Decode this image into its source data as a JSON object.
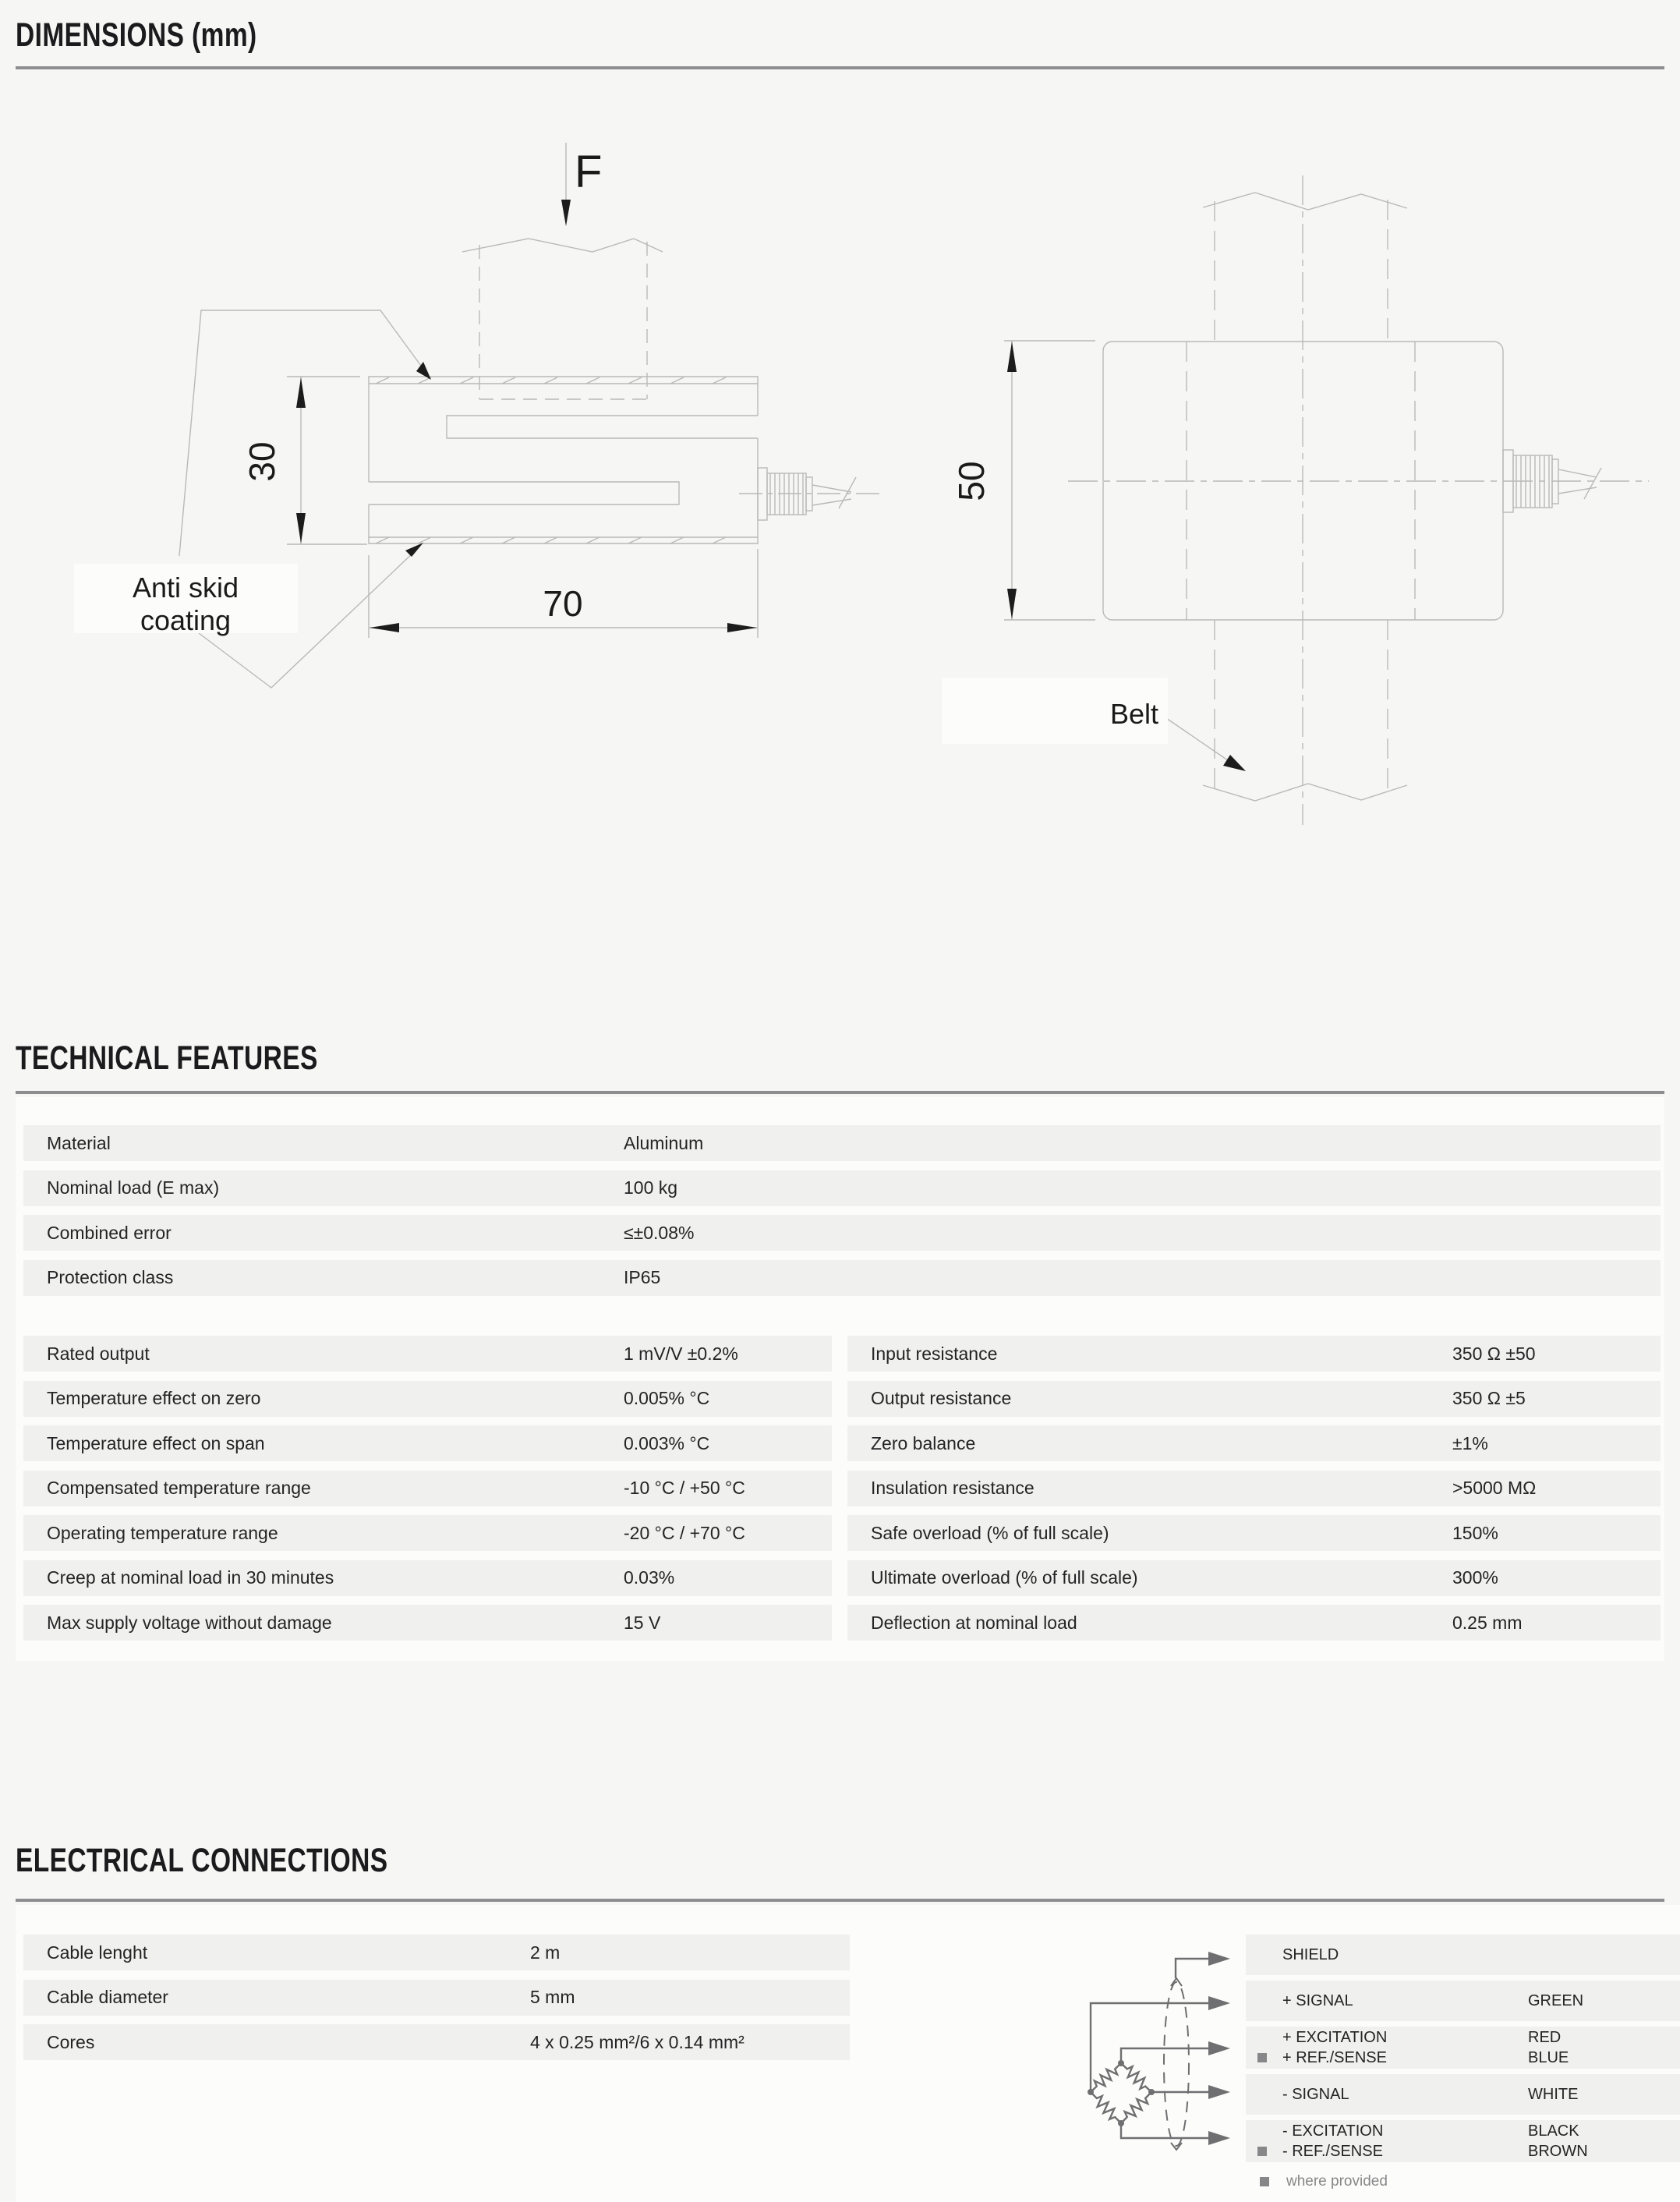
{
  "sections": {
    "dimensions_title": "DIMENSIONS (mm)",
    "technical_title": "TECHNICAL FEATURES",
    "electrical_title": "ELECTRICAL CONNECTIONS"
  },
  "drawing_left": {
    "force_label": "F",
    "height_dim": "30",
    "width_dim": "70",
    "coating_label_line1": "Anti skid",
    "coating_label_line2": "coating"
  },
  "drawing_right": {
    "height_dim": "50",
    "belt_label": "Belt"
  },
  "technical_table_top": [
    {
      "label": "Material",
      "value": "Aluminum"
    },
    {
      "label": "Nominal load (E max)",
      "value": "100 kg"
    },
    {
      "label": "Combined error",
      "value": "≤±0.08%"
    },
    {
      "label": "Protection class",
      "value": "IP65"
    }
  ],
  "technical_table_left": [
    {
      "label": "Rated output",
      "value": "1 mV/V ±0.2%"
    },
    {
      "label": "Temperature effect on zero",
      "value": "0.005% °C"
    },
    {
      "label": "Temperature effect on span",
      "value": "0.003% °C"
    },
    {
      "label": "Compensated temperature range",
      "value": "-10 °C / +50 °C"
    },
    {
      "label": "Operating temperature range",
      "value": "-20 °C / +70 °C"
    },
    {
      "label": "Creep at nominal load in 30 minutes",
      "value": "0.03%"
    },
    {
      "label": "Max supply voltage without damage",
      "value": "15 V"
    }
  ],
  "technical_table_right": [
    {
      "label": "Input resistance",
      "value": "350 Ω ±50"
    },
    {
      "label": "Output resistance",
      "value": "350 Ω ±5"
    },
    {
      "label": "Zero balance",
      "value": "±1%"
    },
    {
      "label": "Insulation resistance",
      "value": ">5000 MΩ"
    },
    {
      "label": "Safe overload (% of full scale)",
      "value": "150%"
    },
    {
      "label": "Ultimate overload (% of full scale)",
      "value": "300%"
    },
    {
      "label": "Deflection at nominal load",
      "value": "0.25 mm"
    }
  ],
  "electrical_table": [
    {
      "label": "Cable lenght",
      "value": "2 m"
    },
    {
      "label": "Cable diameter",
      "value": "5 mm"
    },
    {
      "label": "Cores",
      "value": "4 x 0.25 mm²/6 x 0.14 mm²"
    }
  ],
  "wiring": {
    "rows": [
      {
        "lines": [
          {
            "label": "SHIELD",
            "color": ""
          }
        ]
      },
      {
        "lines": [
          {
            "label": "+ SIGNAL",
            "color": "GREEN"
          }
        ]
      },
      {
        "lines": [
          {
            "label": "+ EXCITATION",
            "color": "RED"
          },
          {
            "label": "+ REF./SENSE",
            "color": "BLUE"
          }
        ]
      },
      {
        "lines": [
          {
            "label": "- SIGNAL",
            "color": "WHITE"
          }
        ]
      },
      {
        "lines": [
          {
            "label": "- EXCITATION",
            "color": "BLACK"
          },
          {
            "label": "- REF./SENSE",
            "color": "BROWN"
          }
        ]
      }
    ],
    "footnote": "where provided"
  },
  "colors": {
    "page_bg": "#f6f6f4",
    "panel_bg": "#fcfcfa",
    "row_bg": "#f0f0ee",
    "rule_gray": "#8d8d8f",
    "drawing_line": "#b9b9b7",
    "wiring_line": "#6f6f71",
    "marker_gray": "#87878a",
    "text_dark": "#242426"
  }
}
